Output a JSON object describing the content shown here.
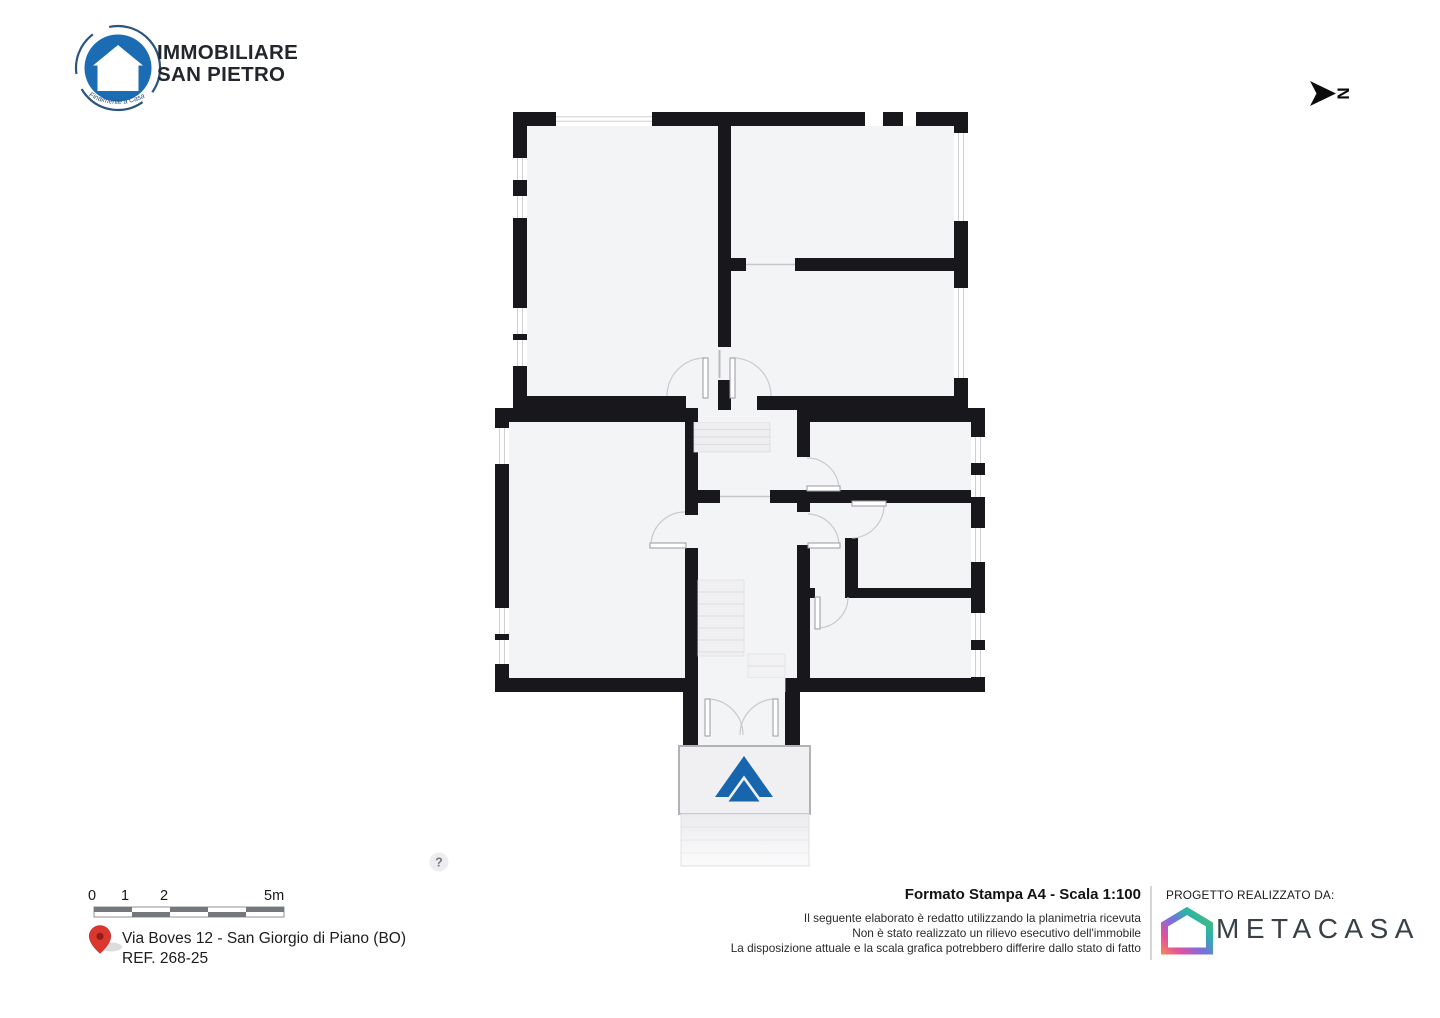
{
  "branding": {
    "name_line1": "IMMOBILIARE",
    "name_line2": "SAN PIETRO",
    "tagline": "Finalmente a Casa"
  },
  "north_indicator": {
    "label": "N"
  },
  "plan": {
    "scale_bar_labels": [
      "0",
      "1",
      "2",
      "5m"
    ],
    "help_icon": "?"
  },
  "address": {
    "line1": "Via Boves 12 - San Giorgio di Piano (BO)",
    "line2": "REF. 268-25"
  },
  "print_info": {
    "title": "Formato Stampa A4 - Scala 1:100",
    "disclaimer_lines": [
      "Il seguente elaborato è redatto utilizzando la planimetria ricevuta",
      "Non è stato realizzato un rilievo esecutivo dell'immobile",
      "La disposizione attuale e la scala grafica potrebbero differire dallo stato di fatto"
    ]
  },
  "credits": {
    "label": "PROGETTO REALIZZATO DA:",
    "company": "METACASA"
  },
  "colors": {
    "wall": "#18181c",
    "floor": "#f3f4f6",
    "brand_blue": "#1b6cb3",
    "entrance_arrow_blue": "#1765ad",
    "pin_red": "#da382e",
    "metacasa_gradient": [
      "#5bc262",
      "#2ab3a8",
      "#7a6fe0",
      "#e0519e",
      "#f2815c"
    ]
  }
}
